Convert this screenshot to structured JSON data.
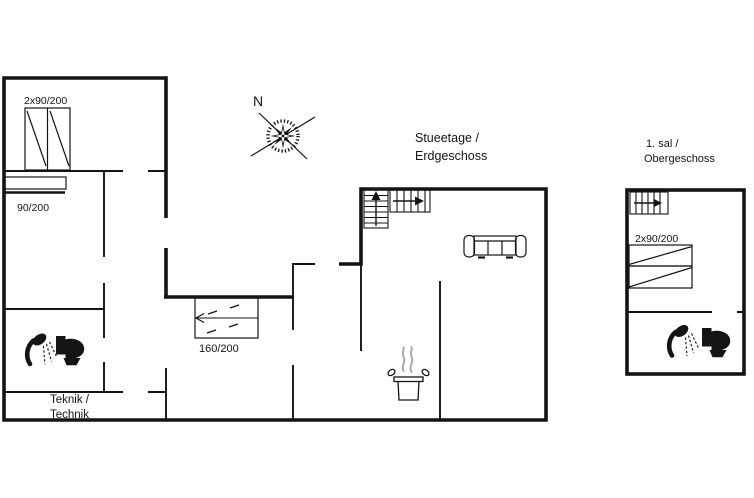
{
  "floorplan": {
    "ground": {
      "title_line1": "Stueetage /",
      "title_line2": "Erdgeschoss",
      "bed_double_label": "2x90/200",
      "bed_single_label": "90/200",
      "bed_160_label": "160/200",
      "technik_line1": "Teknik /",
      "technik_line2": "Technik"
    },
    "upper": {
      "title_line1": "1. sal /",
      "title_line2": "Obergeschoss",
      "bed_double_label": "2x90/200"
    },
    "compass": {
      "north": "N"
    },
    "colors": {
      "line": "#141414",
      "background": "#ffffff",
      "steam": "#a9a9a9"
    },
    "icons": {
      "compass": "compass-rose-icon",
      "stairs": "stairs-icon",
      "sofa": "sofa-icon",
      "shower": "shower-icon",
      "toilet": "toilet-icon",
      "cooking_pot": "cooking-pot-icon"
    }
  }
}
